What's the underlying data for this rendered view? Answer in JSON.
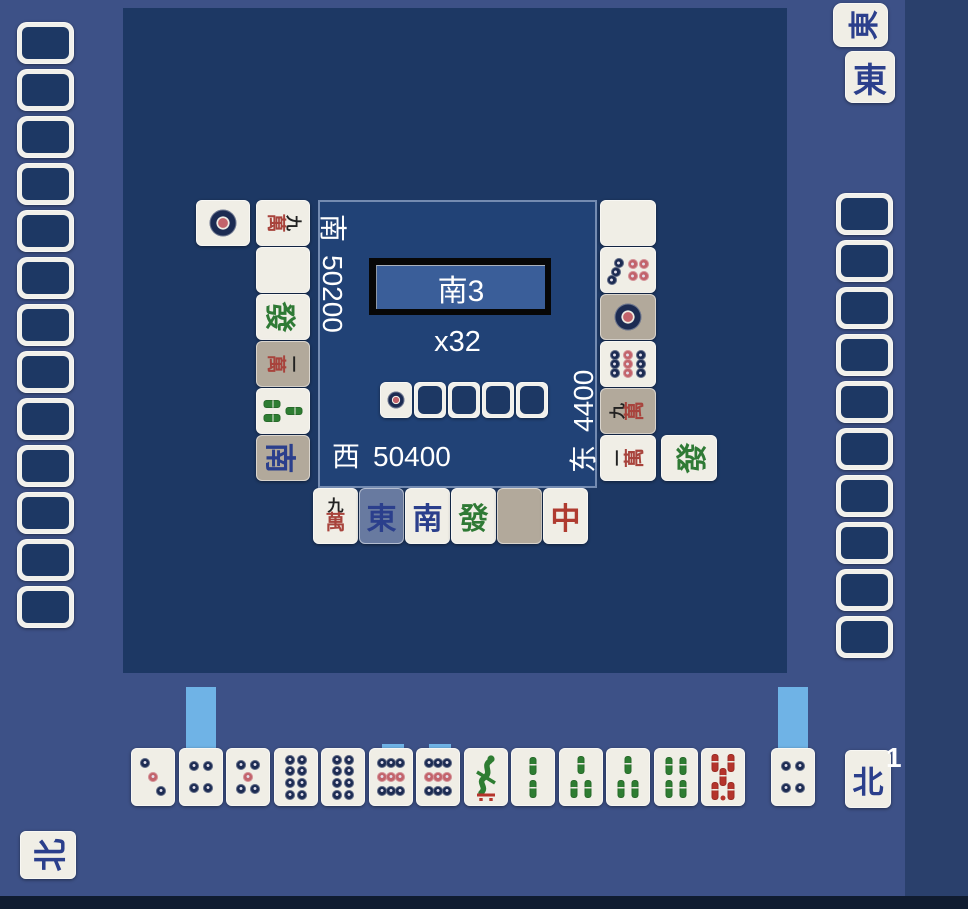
{
  "colors": {
    "background": "#3D5187",
    "side_panel": "#2A406C",
    "bottom_bar": "#101C30",
    "table": "#1D3864",
    "panel": "#214276",
    "button_fill": "#3A5E99",
    "tile_face": "#F0EEE6",
    "tile_face_dim": "#B2A99B",
    "tile_face_highlight": "#687AA0",
    "tile_back": "#1D3864",
    "hint": "#6FB3E6",
    "pin_blue": "#1C2B52",
    "pin_red": "#C2636B",
    "sou_green": "#2E7D32",
    "sou_red": "#B5342C",
    "man_black": "#222222",
    "man_red": "#A8433C",
    "wind_blue": "#2B3F8C",
    "dragon_green": "#2F7A35",
    "dragon_red": "#AF3B30",
    "text": "#FFFFFF"
  },
  "tile_glyphs": {
    "E": "東",
    "S": "南",
    "W": "西",
    "N": "北",
    "G": "發",
    "R": "中",
    "m": "萬",
    "m1": "一",
    "m9": "九"
  },
  "center": {
    "round_label": "南3",
    "wall_count_label": "x32",
    "dora_indicators": [
      {
        "t": "1p"
      },
      {
        "t": "back"
      },
      {
        "t": "back"
      },
      {
        "t": "back"
      },
      {
        "t": "back"
      }
    ],
    "scores": {
      "left": {
        "seat": "南",
        "points": "50200"
      },
      "bottom": {
        "seat": "西",
        "points": "50400"
      },
      "right": {
        "seat": "东",
        "points": "4400"
      }
    }
  },
  "left_player": {
    "hand_tile_count": 13,
    "discards": {
      "col1": [
        {
          "t": "9m"
        },
        {
          "t": "Wh"
        },
        {
          "t": "G"
        },
        {
          "t": "1m",
          "bg": "dim"
        },
        {
          "t": "3s"
        },
        {
          "t": "S",
          "bg": "dim"
        }
      ],
      "col2": [
        {
          "t": "1p"
        }
      ]
    },
    "nuki": {
      "t": "N"
    }
  },
  "right_player": {
    "hand_tile_count": 10,
    "discards": {
      "col1": [
        {
          "t": "Wh"
        },
        {
          "t": "7p"
        },
        {
          "t": "1p",
          "bg": "dim"
        },
        {
          "t": "9p"
        },
        {
          "t": "9m",
          "bg": "dim"
        },
        {
          "t": "1m"
        }
      ],
      "col2_start_row": 5,
      "col2": [
        {
          "t": "G"
        }
      ]
    },
    "meld": [
      {
        "t": "E",
        "rot": true
      },
      {
        "t": "E"
      }
    ]
  },
  "self_player": {
    "discards": [
      {
        "t": "9m"
      },
      {
        "t": "E",
        "bg": "highlight"
      },
      {
        "t": "S"
      },
      {
        "t": "G"
      },
      {
        "t": "Wh",
        "bg": "dim"
      },
      {
        "t": "R"
      }
    ],
    "hand": [
      {
        "t": "3p"
      },
      {
        "t": "4p",
        "hint": "tall"
      },
      {
        "t": "5p"
      },
      {
        "t": "8p"
      },
      {
        "t": "8p"
      },
      {
        "t": "9p",
        "hint": "small"
      },
      {
        "t": "9p",
        "hint": "small"
      },
      {
        "t": "1s"
      },
      {
        "t": "2s"
      },
      {
        "t": "3s"
      },
      {
        "t": "3s"
      },
      {
        "t": "4s"
      },
      {
        "t": "0s"
      }
    ],
    "drawn": {
      "t": "4p",
      "hint": "tall"
    },
    "nuki": {
      "t": "N",
      "count": "1"
    }
  }
}
